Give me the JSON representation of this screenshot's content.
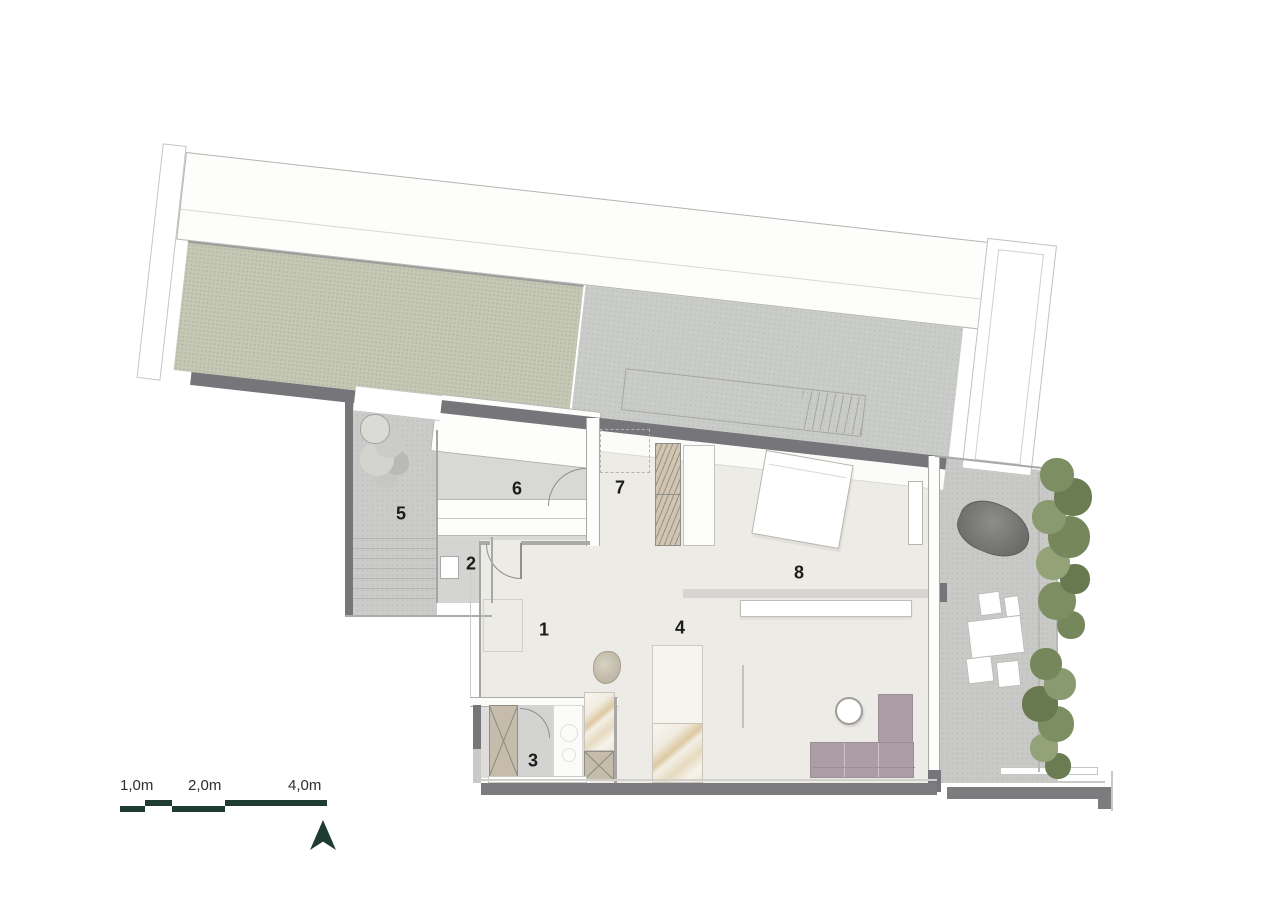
{
  "plan": {
    "title": "apartment-floor-plan",
    "room_labels": [
      {
        "id": "room-1",
        "label": "1"
      },
      {
        "id": "room-2",
        "label": "2"
      },
      {
        "id": "room-3",
        "label": "3"
      },
      {
        "id": "room-4",
        "label": "4"
      },
      {
        "id": "room-5",
        "label": "5"
      },
      {
        "id": "room-6",
        "label": "6"
      },
      {
        "id": "room-7",
        "label": "7"
      },
      {
        "id": "room-8",
        "label": "8"
      }
    ],
    "scale_bar": {
      "labels": [
        "1,0m",
        "2,0m",
        "4,0m"
      ]
    },
    "compass": {
      "type": "north-arrow"
    },
    "colors": {
      "interior_floor": "#edebe6",
      "secondary_floor": "#d8d8d5",
      "patio_floor": "#cbcbc9",
      "terrace_floor": "#c9cac7",
      "green_roof": "#c6c8b6",
      "gravel_roof": "#caccc9",
      "wall_dark": "#76767a",
      "sofa_mauve": "#ab9ea7",
      "wood_tan": "#cfc5b2",
      "tree_green": "#76875c",
      "scale_green": "#1f3c33"
    }
  }
}
